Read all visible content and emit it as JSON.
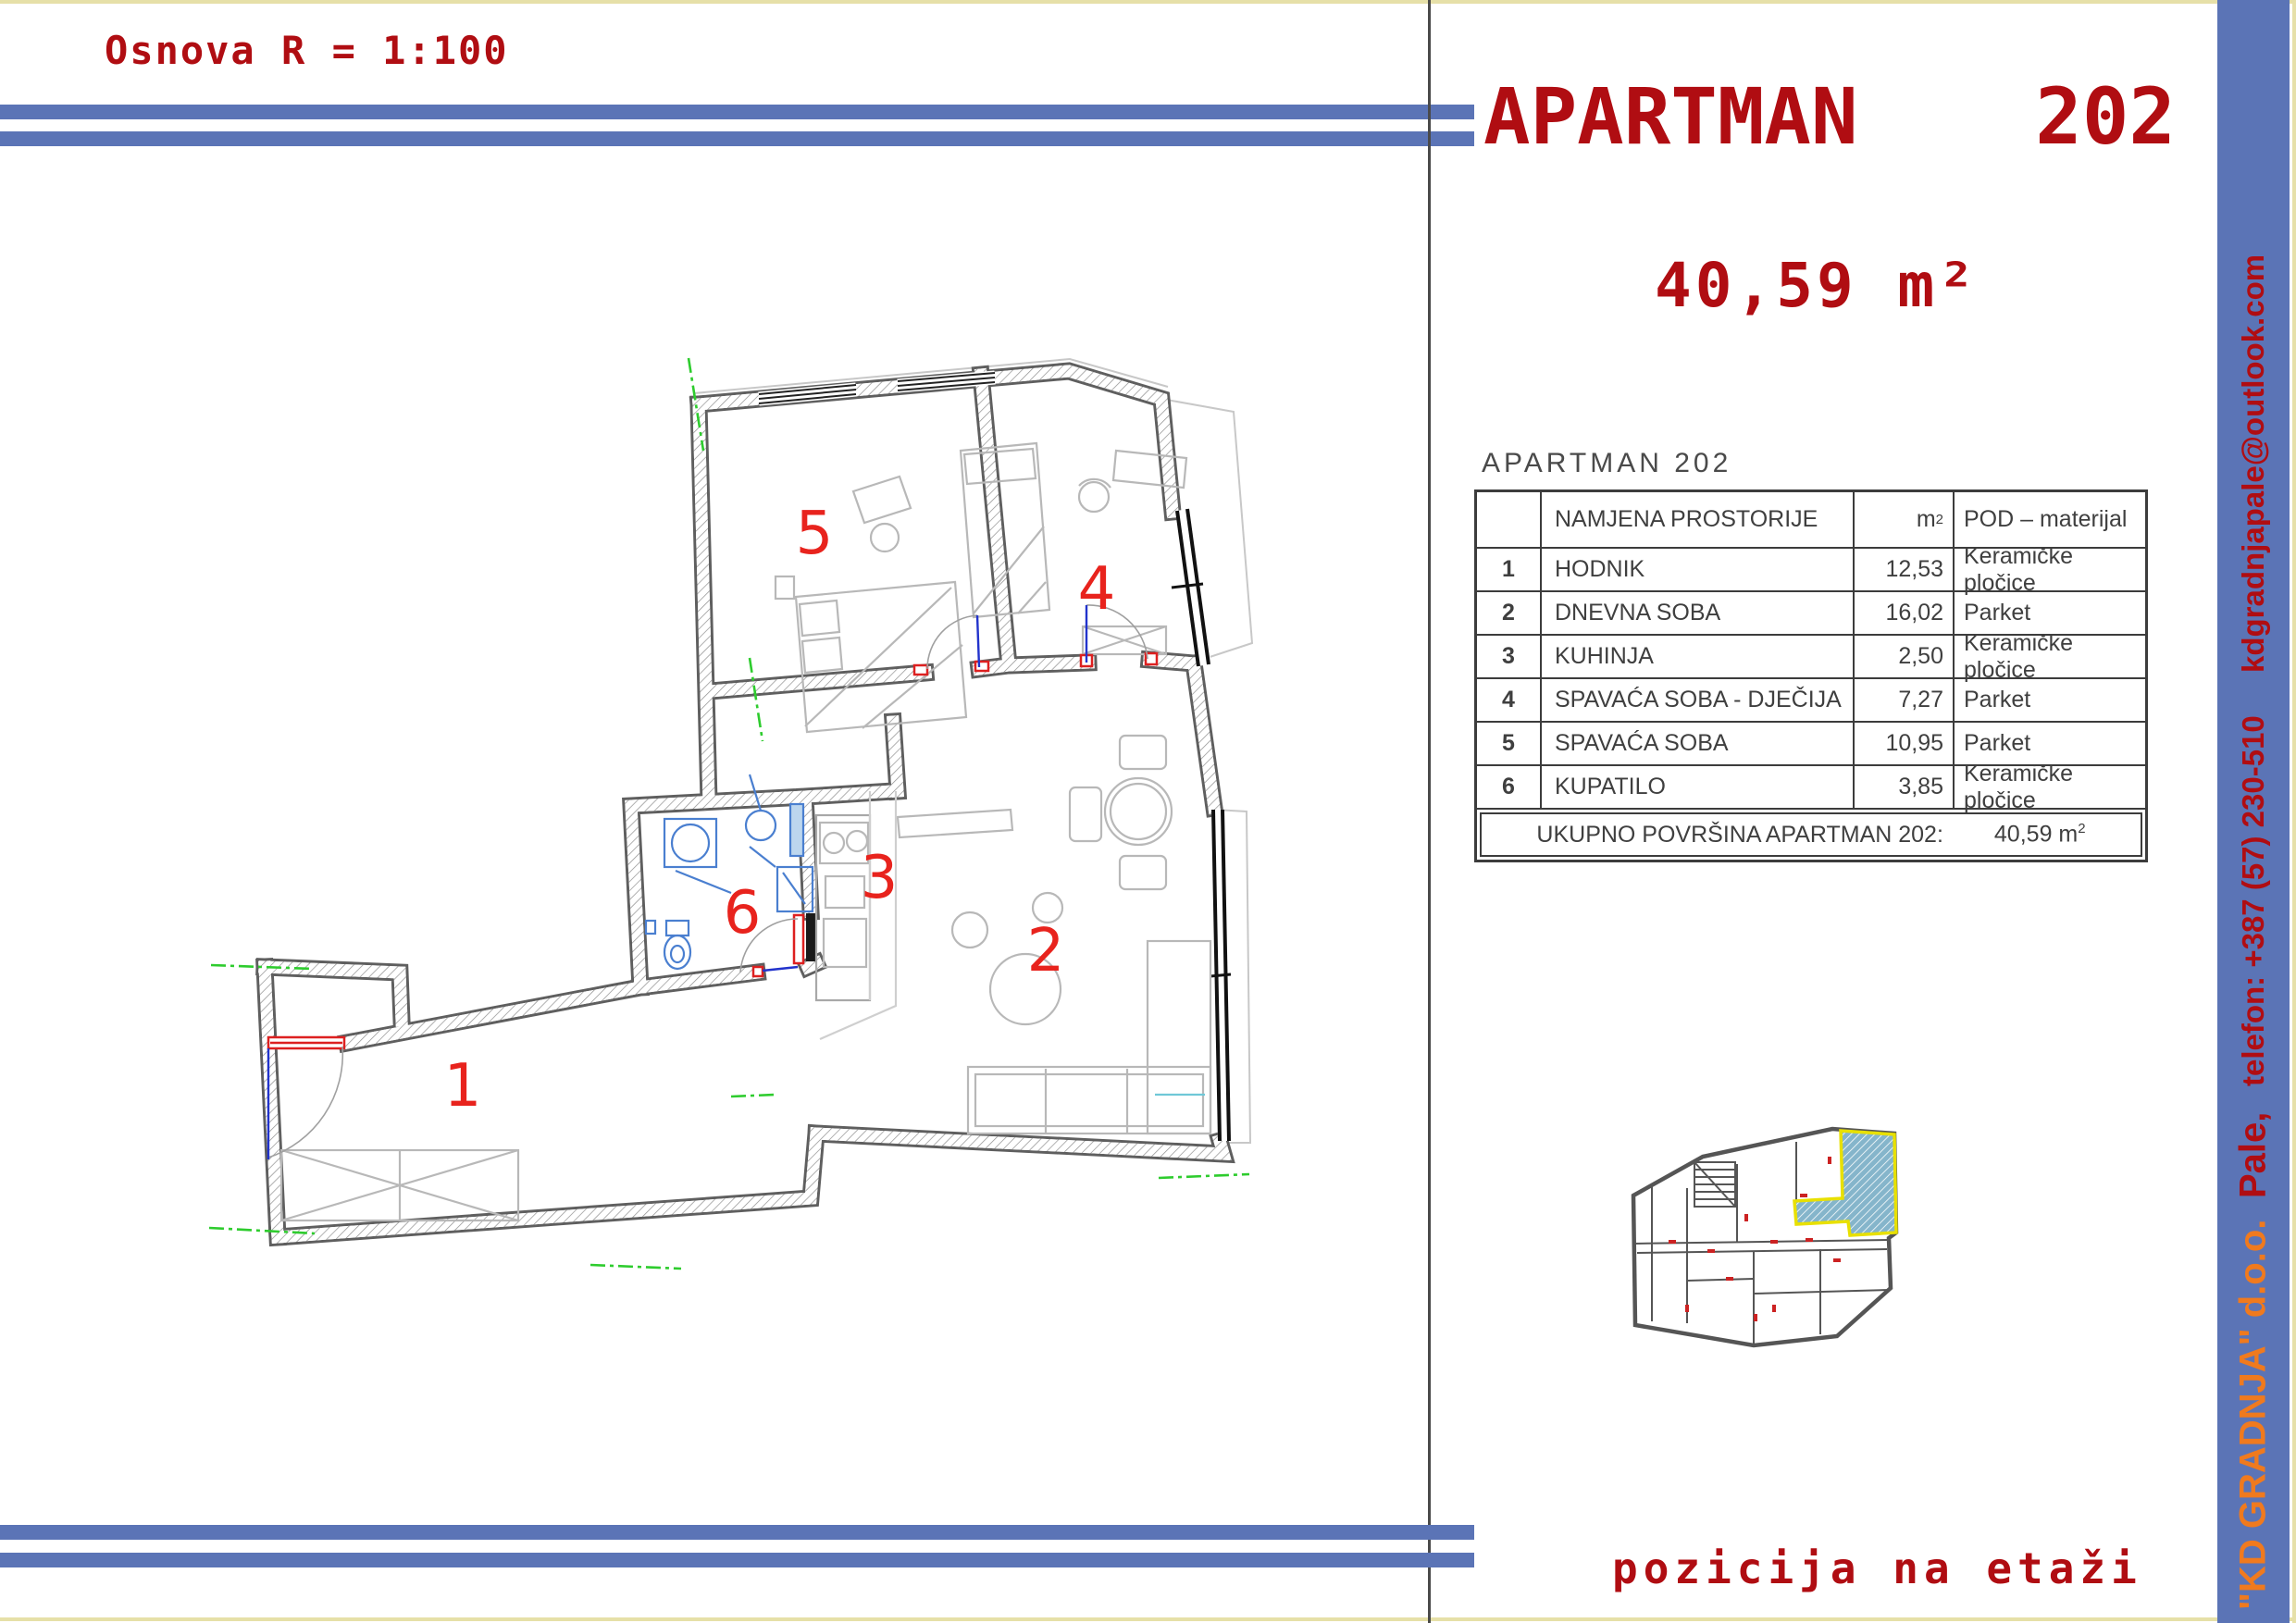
{
  "page": {
    "scale_label": "Osnova R = 1:100",
    "position_label": "pozicija na etaži"
  },
  "header": {
    "title": "APARTMAN",
    "apartment_no": "202",
    "area": "40,59 m²"
  },
  "sidebar": {
    "company": "\"KD GRADNJA\" d.o.o.",
    "city": "Pale,",
    "phone": "telefon: +387 (57) 230-510",
    "email": "kdgradnjapale@outlook.com"
  },
  "table": {
    "heading": "APARTMAN  202",
    "columns": {
      "name": "NAMJENA PROSTORIJE",
      "area_unit": "m",
      "area_sup": "2",
      "floor": "POD – materijal"
    },
    "rows": [
      {
        "no": "1",
        "name": "HODNIK",
        "area": "12,53",
        "floor": "Keramičke pločice"
      },
      {
        "no": "2",
        "name": "DNEVNA SOBA",
        "area": "16,02",
        "floor": "Parket"
      },
      {
        "no": "3",
        "name": "KUHINJA",
        "area": "2,50",
        "floor": "Keramičke pločice"
      },
      {
        "no": "4",
        "name": "SPAVAĆA SOBA - DJEČIJA",
        "area": "7,27",
        "floor": "Parket"
      },
      {
        "no": "5",
        "name": "SPAVAĆA SOBA",
        "area": "10,95",
        "floor": "Parket"
      },
      {
        "no": "6",
        "name": "KUPATILO",
        "area": "3,85",
        "floor": "Keramičke pločice"
      }
    ],
    "total_label": "UKUPNO POVRŠINA APARTMAN 202:",
    "total_value": "40,59 m",
    "total_sup": "2"
  },
  "plan": {
    "room_numbers": [
      "1",
      "2",
      "3",
      "4",
      "5",
      "6"
    ]
  },
  "colors": {
    "accent_red": "#b00d12",
    "bar_blue": "#5b74b6",
    "company_orange": "#f07a1e",
    "plan_number_red": "#e8231d",
    "axis_green": "#2ecc2e",
    "highlight_fill": "#85b5cb",
    "highlight_outline": "#e8e000"
  }
}
